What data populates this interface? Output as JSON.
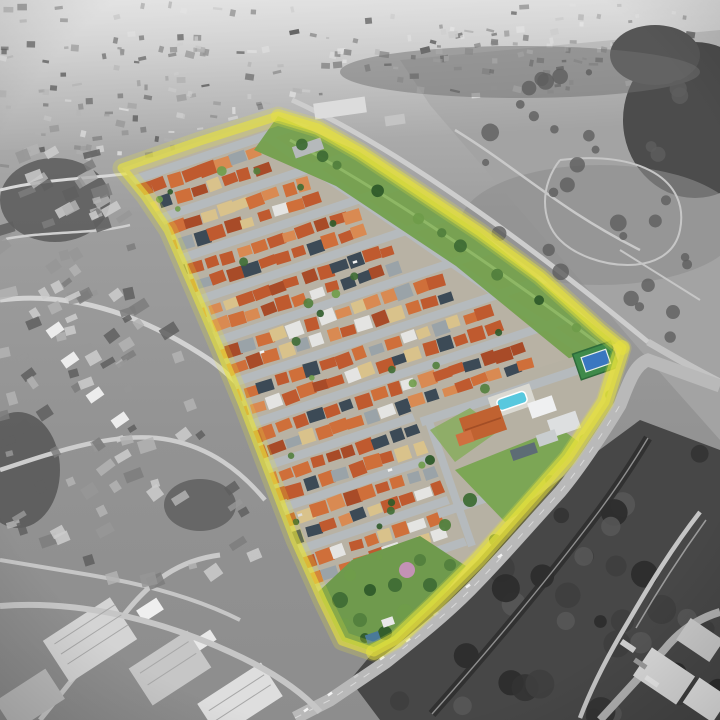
{
  "image": {
    "kind": "aerial-drone-photograph",
    "subject": "Oblique aerial photo of a residential condominium shown in full color and outlined in yellow, surrounded by desaturated grayscale city, fields, industry and forest",
    "highlight_boundary": {
      "color": "#e7e33c",
      "opacity": 0.6
    },
    "palette": {
      "roofs": [
        "#bf5a2f",
        "#cf6f3a",
        "#d98a52",
        "#a84b28",
        "#d9c28b",
        "#3c4a56",
        "#e4e4e2",
        "#9aa3a8"
      ],
      "roof_weights": [
        3,
        2,
        1,
        1,
        1,
        0.8,
        0.8,
        0.6
      ],
      "street": "#b5babd",
      "lot_ground": "#b8b2a4",
      "grass": "#74a04e",
      "lawn": "#7ca655",
      "tree_greens": [
        "#3f6d35",
        "#527f3d",
        "#2f5b2a",
        "#6f9c4a"
      ],
      "pink_tree": "#c791bb",
      "pool_water": "#58c8de",
      "pool_deck": "#dad9d2",
      "court_green": "#3f8a4a",
      "court_blue": "#3a77c0",
      "clubhouse_roof": "#c06231",
      "grays": [
        "#e2e2e2",
        "#cccccc",
        "#b3b3b3",
        "#979797",
        "#7c7c7c",
        "#5f5f5f"
      ],
      "field_gray": "#a3a3a3",
      "forest_gray": "#474747",
      "road_gray": "#b9b9b9",
      "railway_dark": "#2f2f2f",
      "river_white": "#dcdcdc",
      "industrial_light": "#d6d6d6",
      "car_white": "#f2f2f2"
    }
  }
}
